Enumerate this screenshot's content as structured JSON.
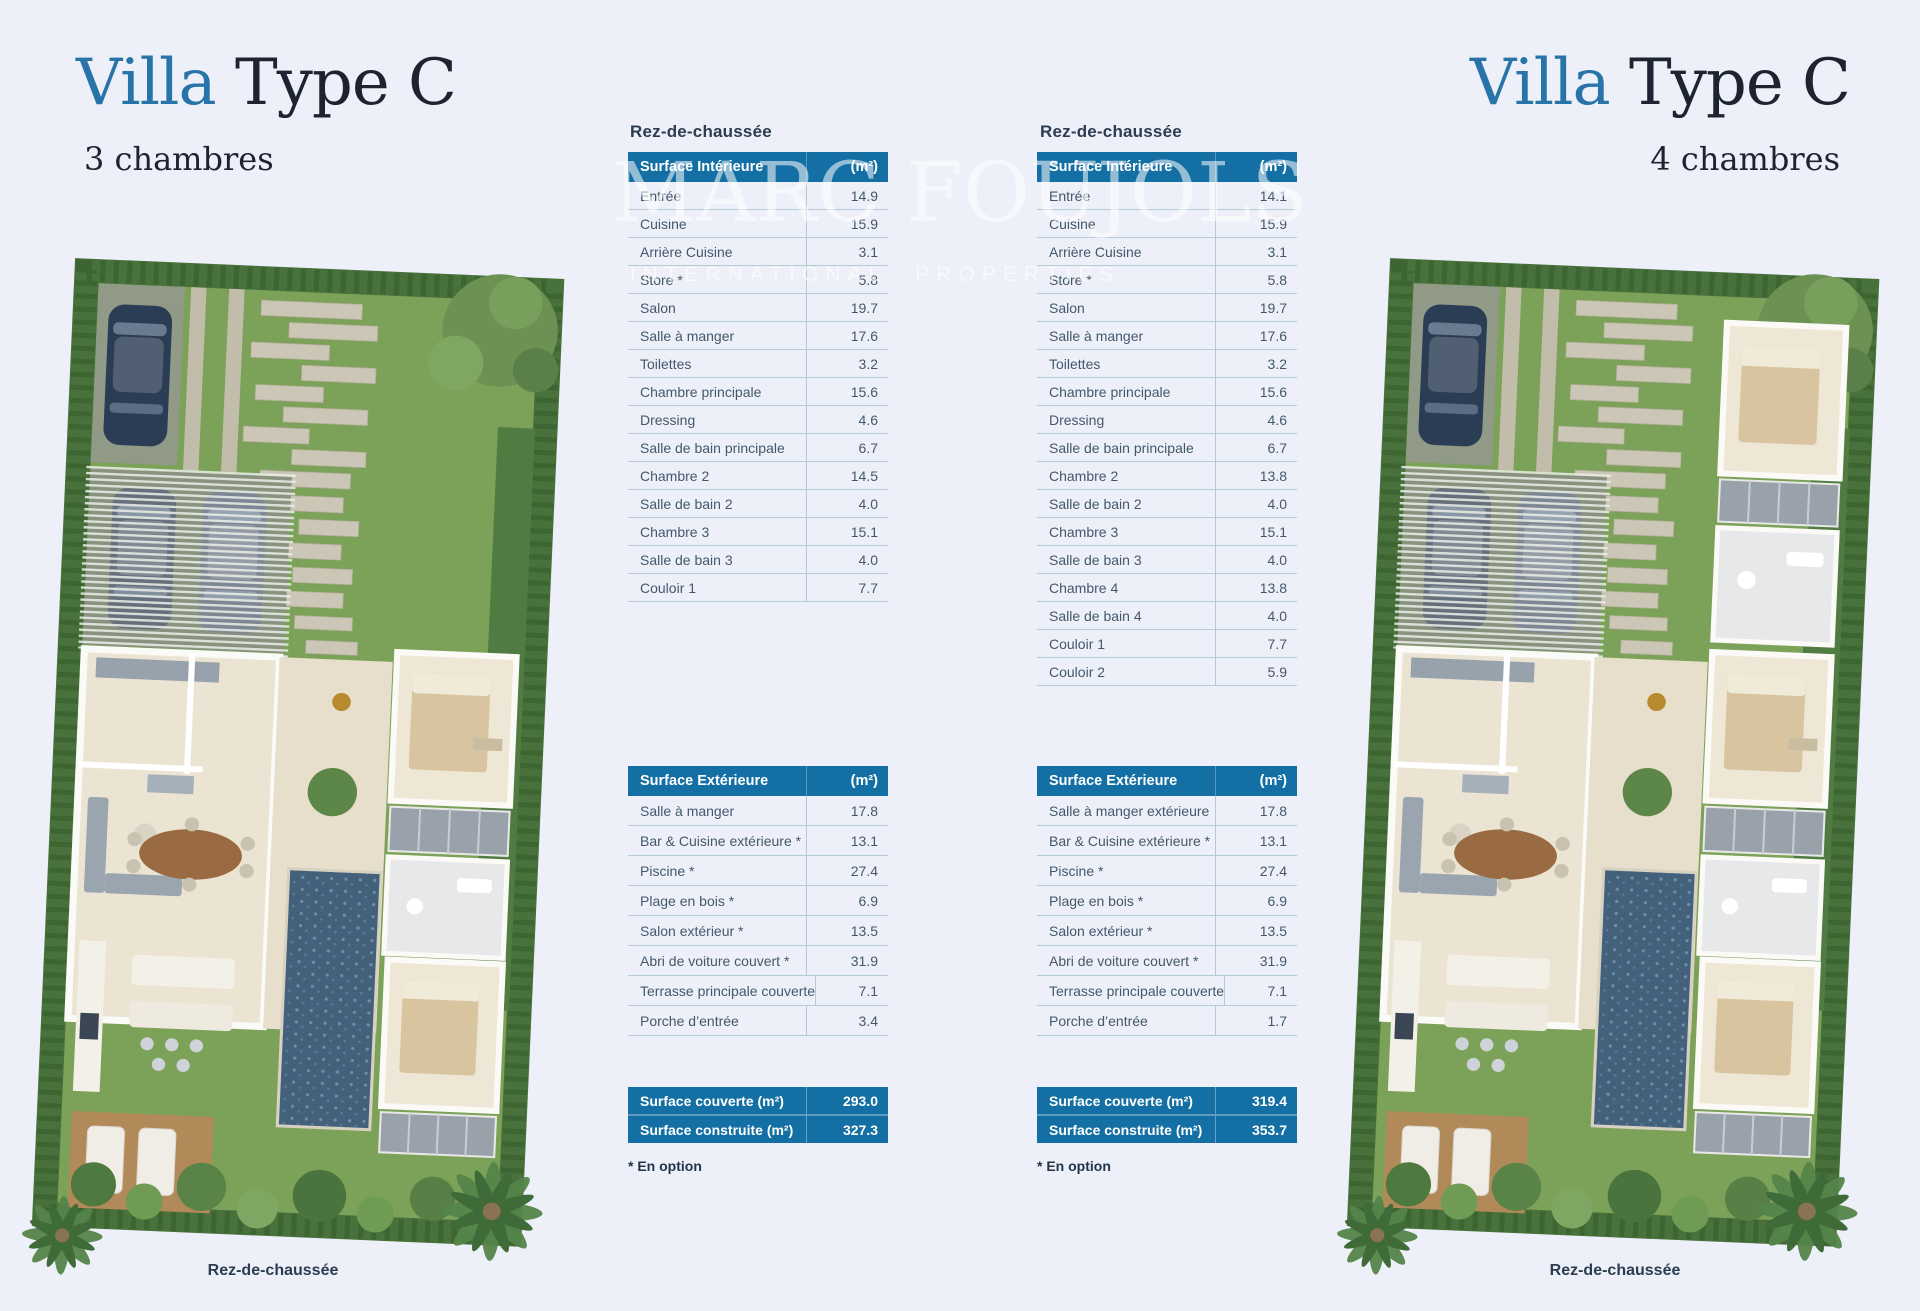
{
  "watermark": {
    "line1": "MARC FOUJOLS",
    "line2_left": "INTERNATIONAL",
    "line2_right": "PROPERTIES",
    "square_color": "#c14553"
  },
  "colors": {
    "background": "#edf0f8",
    "table_blue": "#1470a4",
    "title_blue": "#2873a8",
    "title_dark": "#1d2330",
    "red_square": "#c14553"
  },
  "left": {
    "title": {
      "word1": "Villa",
      "word2": " Type C",
      "subtitle": "3 chambres"
    },
    "section_heading": "Rez-de-chaussée",
    "plan_caption": "Rez-de-chaussée",
    "interior": {
      "header": "Surface Intérieure",
      "unit": "(m²)",
      "rows": [
        [
          "Entrée",
          "14.9"
        ],
        [
          "Cuisine",
          "15.9"
        ],
        [
          "Arrière Cuisine",
          "3.1"
        ],
        [
          "Store *",
          "5.8"
        ],
        [
          "Salon",
          "19.7"
        ],
        [
          "Salle à manger",
          "17.6"
        ],
        [
          "Toilettes",
          "3.2"
        ],
        [
          "Chambre principale",
          "15.6"
        ],
        [
          "Dressing",
          "4.6"
        ],
        [
          "Salle de bain principale",
          "6.7"
        ],
        [
          "Chambre 2",
          "14.5"
        ],
        [
          "Salle de bain 2",
          "4.0"
        ],
        [
          "Chambre 3",
          "15.1"
        ],
        [
          "Salle de bain 3",
          "4.0"
        ],
        [
          "Couloir 1",
          "7.7"
        ]
      ]
    },
    "exterior": {
      "header": "Surface Extérieure",
      "unit": "(m²)",
      "rows": [
        [
          "Salle à manger",
          "17.8"
        ],
        [
          "Bar & Cuisine extérieure *",
          "13.1"
        ],
        [
          "Piscine *",
          "27.4"
        ],
        [
          "Plage en bois *",
          "6.9"
        ],
        [
          "Salon extérieur *",
          "13.5"
        ],
        [
          "Abri de voiture couvert *",
          "31.9"
        ],
        [
          "Terrasse principale couverte",
          "7.1"
        ],
        [
          "Porche d’entrée",
          "3.4"
        ]
      ]
    },
    "summary": {
      "rows": [
        [
          "Surface couverte (m²)",
          "293.0"
        ],
        [
          "Surface construite (m²)",
          "327.3"
        ]
      ]
    },
    "footnote": "* En option"
  },
  "right": {
    "title": {
      "word1": "Villa",
      "word2": " Type C",
      "subtitle": "4 chambres"
    },
    "section_heading": "Rez-de-chaussée",
    "plan_caption": "Rez-de-chaussée",
    "interior": {
      "header": "Surface Intérieure",
      "unit": "(m²)",
      "rows": [
        [
          "Entrée",
          "14.1"
        ],
        [
          "Cuisine",
          "15.9"
        ],
        [
          "Arrière Cuisine",
          "3.1"
        ],
        [
          "Store *",
          "5.8"
        ],
        [
          "Salon",
          "19.7"
        ],
        [
          "Salle à manger",
          "17.6"
        ],
        [
          "Toilettes",
          "3.2"
        ],
        [
          "Chambre principale",
          "15.6"
        ],
        [
          "Dressing",
          "4.6"
        ],
        [
          "Salle de bain principale",
          "6.7"
        ],
        [
          "Chambre 2",
          "13.8"
        ],
        [
          "Salle de bain 2",
          "4.0"
        ],
        [
          "Chambre 3",
          "15.1"
        ],
        [
          "Salle de bain 3",
          "4.0"
        ],
        [
          "Chambre 4",
          "13.8"
        ],
        [
          "Salle de bain 4",
          "4.0"
        ],
        [
          "Couloir 1",
          "7.7"
        ],
        [
          "Couloir 2",
          "5.9"
        ]
      ]
    },
    "exterior": {
      "header": "Surface Extérieure",
      "unit": "(m²)",
      "rows": [
        [
          "Salle à manger extérieure",
          "17.8"
        ],
        [
          "Bar & Cuisine extérieure *",
          "13.1"
        ],
        [
          "Piscine *",
          "27.4"
        ],
        [
          "Plage en bois *",
          "6.9"
        ],
        [
          "Salon extérieur *",
          "13.5"
        ],
        [
          "Abri de voiture couvert *",
          "31.9"
        ],
        [
          "Terrasse principale couverte",
          "7.1"
        ],
        [
          "Porche d’entrée",
          "1.7"
        ]
      ]
    },
    "summary": {
      "rows": [
        [
          "Surface couverte (m²)",
          "319.4"
        ],
        [
          "Surface construite (m²)",
          "353.7"
        ]
      ]
    },
    "footnote": "* En option"
  }
}
